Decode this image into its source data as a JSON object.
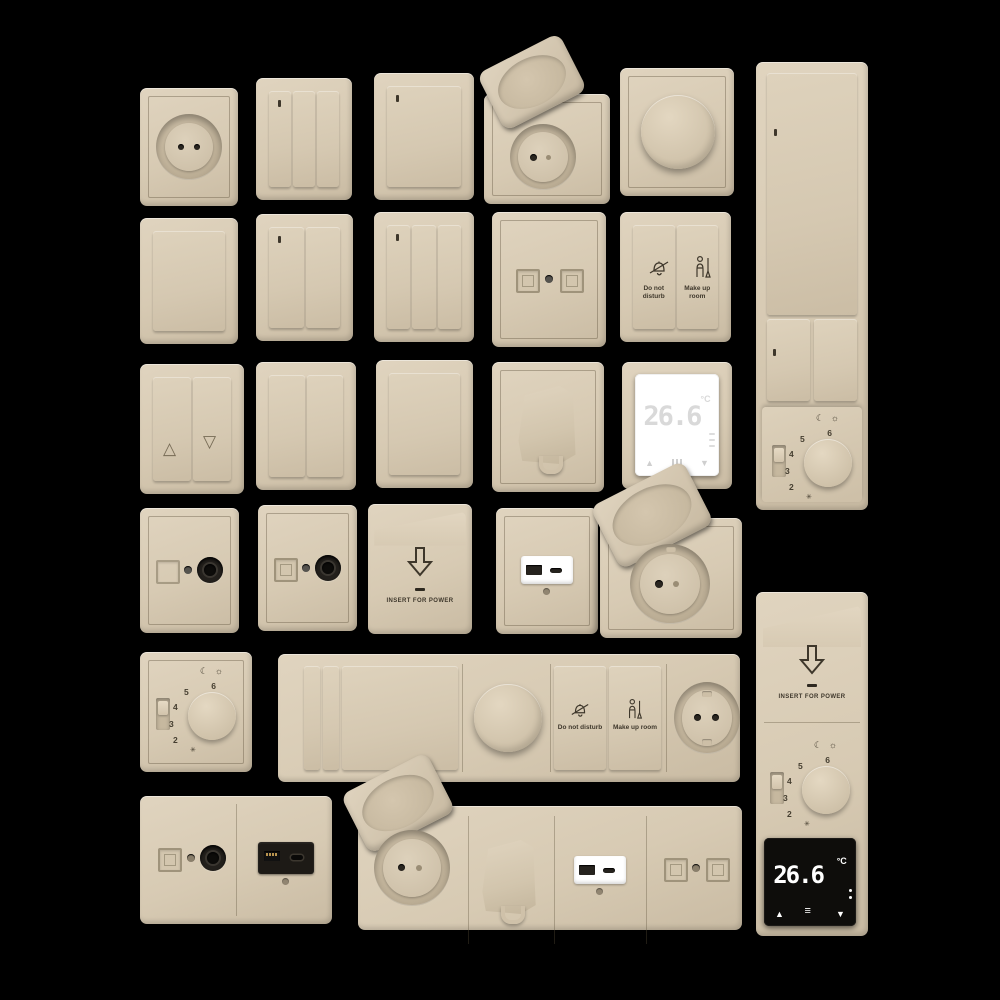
{
  "background": "#000000",
  "palette": {
    "plate": "#d7cab3",
    "plate_light": "#e0d4bf",
    "plate_dark": "#c9bba3",
    "engraving": "#4a4234",
    "insert_black": "#1d1a16",
    "insert_white": "#ffffff",
    "white_display_digits": "#d9d9d9",
    "black_display": "#0e0d0b"
  },
  "labels": {
    "do_not_disturb": "Do not disturb",
    "make_up_room": "Make up room",
    "insert_for_power": "INSERT FOR POWER"
  },
  "thermostat_display": {
    "value": "26.6",
    "unit": "°C"
  },
  "dial": {
    "numbers": [
      "2",
      "3",
      "4",
      "5",
      "6"
    ],
    "moon": "☾",
    "sun": "☼",
    "frost": "✳"
  },
  "glyphs": {
    "up_triangle": "△",
    "down_triangle": "▽",
    "up_arrow": "▲",
    "down_arrow": "▼",
    "menu": "≡"
  },
  "items": [
    "EU round socket",
    "3-gang switch",
    "1-gang switch",
    "flip-lid socket",
    "rotary dimmer",
    "vertical multi-switch panel with thermostat dial",
    "1-gang blank switch",
    "2-gang switch",
    "3-gang switch",
    "dual data outlet",
    "do-not-disturb / make-up-room switch",
    "blind control switch",
    "2-gang switch",
    "1-gang switch",
    "cable outlet",
    "digital thermostat white",
    "TV coax outlet A",
    "TV coax outlet B",
    "key card power holder",
    "USB A+C charger outlet white",
    "flip-lid socket large",
    "thermostat dial plate",
    "horizontal strip: switches, dimmer, service buttons, socket",
    "double outlet: coax + USB A+C black",
    "horizontal strip: flip-lid socket, cable outlet, USB charger, dual data outlet",
    "vertical panel: key card holder, thermostat dial, digital thermostat black"
  ]
}
